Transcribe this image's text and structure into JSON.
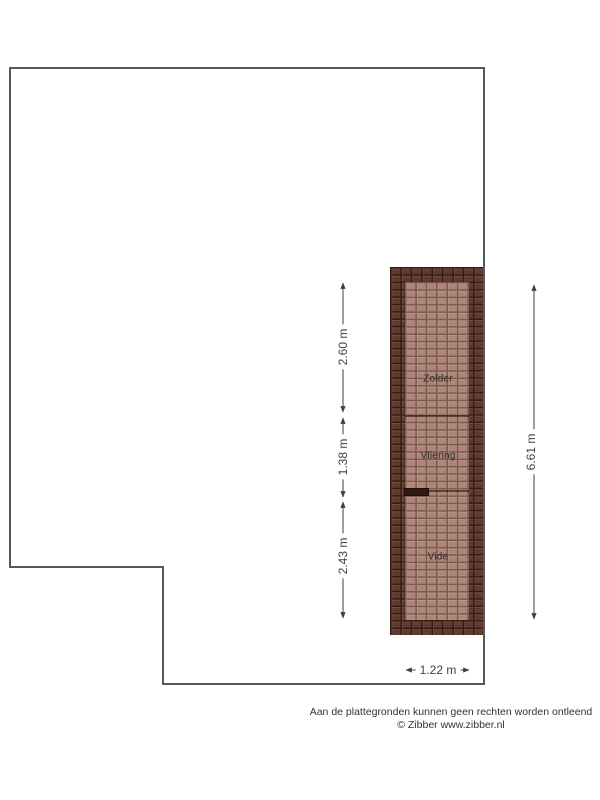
{
  "plan": {
    "floor_type": "attic-floorplan",
    "rooms": [
      {
        "name": "Zolder"
      },
      {
        "name": "Vliering"
      },
      {
        "name": "Vide"
      }
    ],
    "dimensions": [
      {
        "label": "2.60 m",
        "orientation": "vertical"
      },
      {
        "label": "1.38 m",
        "orientation": "vertical"
      },
      {
        "label": "2.43 m",
        "orientation": "vertical"
      },
      {
        "label": "6.61 m",
        "orientation": "vertical"
      },
      {
        "label": "1.22 m",
        "orientation": "horizontal"
      }
    ]
  },
  "footer": {
    "disclaimer": "Aan de plattegronden kunnen geen rechten worden ontleend",
    "credit": "© Zibber www.zibber.nl"
  },
  "colors": {
    "background": "#ffffff",
    "outline": "#58585a",
    "dimension": "#3f3f3f",
    "label_text": "#2e2a27",
    "roof_dark": "#5e3a2f",
    "roof_dark_grout": "#351c12",
    "roof_light": "#ad8679",
    "roof_light_grout": "#7b584c",
    "footer_text": "#333333"
  }
}
